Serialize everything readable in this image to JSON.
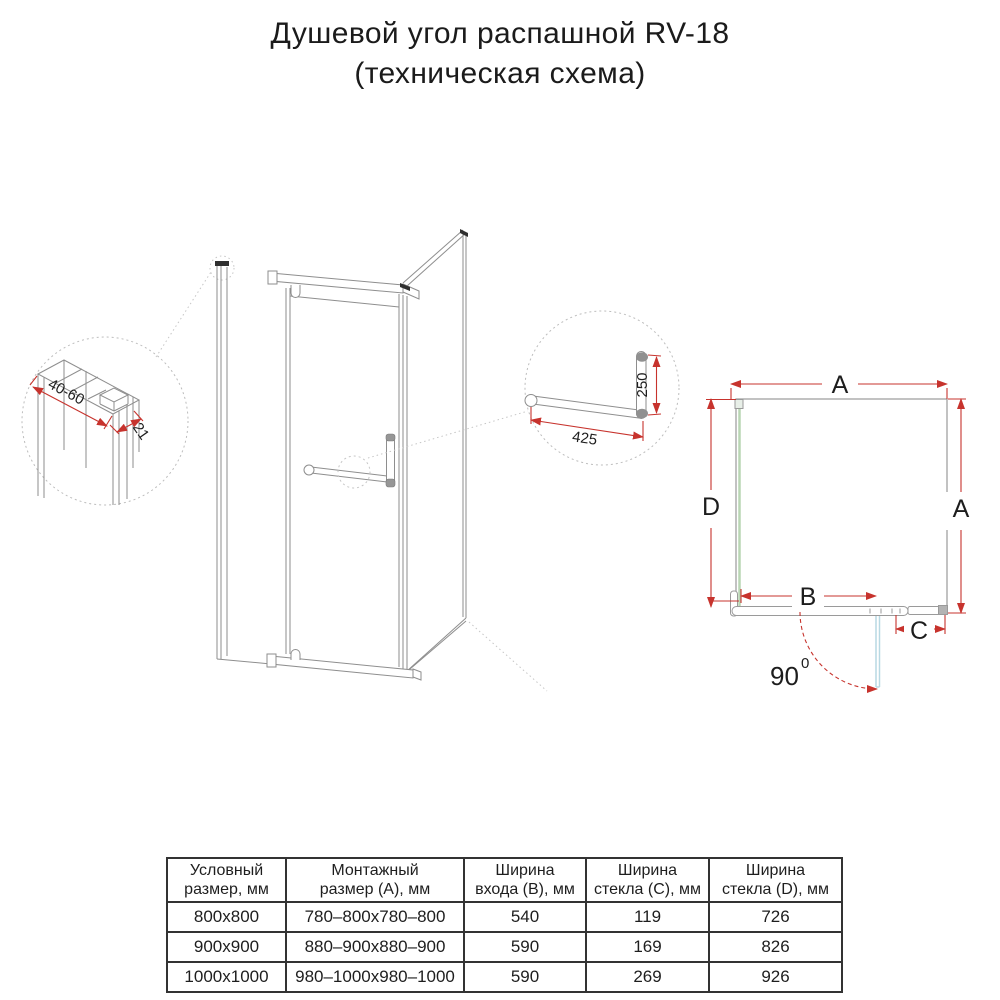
{
  "title": {
    "line1": "Душевой угол распашной RV-18",
    "line2": "(техническая схема)"
  },
  "detail_profile": {
    "width_range": "40-60",
    "depth": "21"
  },
  "detail_handle": {
    "length": "425",
    "height": "250"
  },
  "plan": {
    "dim_top": "A",
    "dim_right": "A",
    "dim_left": "D",
    "dim_entry": "B",
    "dim_panel": "C",
    "angle": "90",
    "angle_sup": "0"
  },
  "colors": {
    "dimension_red": "#c7332d",
    "drawing_gray": "#8e8e8e",
    "glass_green": "#b9d6b4",
    "door_blue": "#b8d9e3",
    "text": "#1d1d1d"
  },
  "table": {
    "headers": [
      "Условный\nразмер, мм",
      "Монтажный\nразмер (А), мм",
      "Ширина\nвхода (В), мм",
      "Ширина\nстекла (С), мм",
      "Ширина\nстекла (D), мм"
    ],
    "rows": [
      [
        "800x800",
        "780–800x780–800",
        "540",
        "119",
        "726"
      ],
      [
        "900x900",
        "880–900x880–900",
        "590",
        "169",
        "826"
      ],
      [
        "1000x1000",
        "980–1000x980–1000",
        "590",
        "269",
        "926"
      ]
    ]
  }
}
